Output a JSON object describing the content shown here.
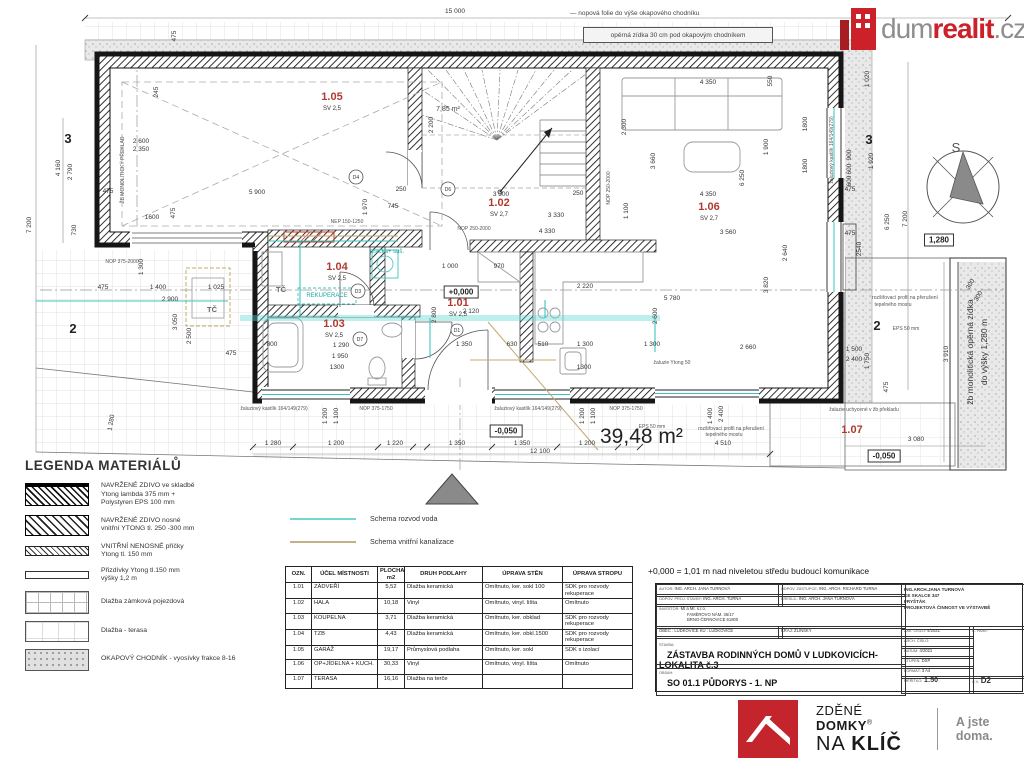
{
  "header": {
    "dim_total": "15 000",
    "note_folie": "— nopová folie do výše okapového chodníku",
    "note_zidka": "opěrná zídka 30 cm pod okapovým chodníkem",
    "logo": {
      "gray1": "dum",
      "red": "realit",
      "gray2": ".cz"
    }
  },
  "plan": {
    "compass_letter": "S",
    "area_label": "39,48 m²",
    "rooms": [
      {
        "id": "1.05",
        "sv": "SV 2,5",
        "x": 332,
        "y": 100
      },
      {
        "id": "1.02",
        "sv": "SV 2,7",
        "x": 499,
        "y": 206
      },
      {
        "id": "1.06",
        "sv": "SV 2,7",
        "x": 709,
        "y": 210
      },
      {
        "id": "1.04",
        "sv": "SV 2,5",
        "x": 337,
        "y": 270
      },
      {
        "id": "1.03",
        "sv": "SV 2,5",
        "x": 334,
        "y": 327
      },
      {
        "id": "1.01",
        "sv": "SV 2,5",
        "x": 458,
        "y": 306
      },
      {
        "id": "1.07",
        "sv": "",
        "x": 852,
        "y": 433
      }
    ],
    "levels": [
      {
        "t": "+0,000",
        "x": 461,
        "y": 292
      },
      {
        "t": "-0,050",
        "x": 506,
        "y": 431
      },
      {
        "t": "-0,050",
        "x": 884,
        "y": 456
      },
      {
        "t": "1,280",
        "x": 939,
        "y": 240
      }
    ],
    "annotations": [
      {
        "t": "15 000",
        "x": 455,
        "y": 13
      },
      {
        "t": "475",
        "x": 176,
        "y": 36,
        "r": -90
      },
      {
        "t": "7 200",
        "x": 31,
        "y": 225,
        "r": -90
      },
      {
        "t": "4 160",
        "x": 60,
        "y": 168,
        "r": -90
      },
      {
        "t": "2 790",
        "x": 72,
        "y": 172,
        "r": -90
      },
      {
        "t": "730",
        "x": 76,
        "y": 230,
        "r": -90
      },
      {
        "t": "3",
        "x": 68,
        "y": 143,
        "c": "g"
      },
      {
        "t": "2",
        "x": 73,
        "y": 333,
        "c": "g"
      },
      {
        "t": "2 600",
        "x": 141,
        "y": 143
      },
      {
        "t": "2 350",
        "x": 141,
        "y": 151
      },
      {
        "t": "245",
        "x": 158,
        "y": 92,
        "r": -90
      },
      {
        "t": "ŽB MONOLITICKÝ PŘEKLAD",
        "x": 124,
        "y": 170,
        "r": -90,
        "c": "t"
      },
      {
        "t": "475",
        "x": 108,
        "y": 193
      },
      {
        "t": "1600",
        "x": 152,
        "y": 219
      },
      {
        "t": "475",
        "x": 175,
        "y": 213,
        "r": -90
      },
      {
        "t": "NOP 375-2000",
        "x": 122,
        "y": 263,
        "c": "t"
      },
      {
        "t": "1 300",
        "x": 143,
        "y": 267,
        "r": -90
      },
      {
        "t": "475",
        "x": 103,
        "y": 289
      },
      {
        "t": "1 400",
        "x": 158,
        "y": 289
      },
      {
        "t": "1 025",
        "x": 216,
        "y": 289
      },
      {
        "t": "2 900",
        "x": 170,
        "y": 301
      },
      {
        "t": "3 050",
        "x": 177,
        "y": 322,
        "r": -90
      },
      {
        "t": "2 500",
        "x": 191,
        "y": 336,
        "r": -90
      },
      {
        "t": "TČ",
        "x": 212,
        "y": 312,
        "c": "k2"
      },
      {
        "t": "475",
        "x": 231,
        "y": 355
      },
      {
        "t": "1 280",
        "x": 113,
        "y": 423,
        "r": -80
      },
      {
        "t": "5 900",
        "x": 257,
        "y": 194
      },
      {
        "t": "250",
        "x": 401,
        "y": 191
      },
      {
        "t": "745",
        "x": 393,
        "y": 208
      },
      {
        "t": "1 970",
        "x": 367,
        "y": 207,
        "r": -90
      },
      {
        "t": "NEP 150-1250",
        "x": 347,
        "y": 223,
        "c": "t"
      },
      {
        "t": "7,85 m²",
        "x": 448,
        "y": 111,
        "c": "t2"
      },
      {
        "t": "2 200",
        "x": 433,
        "y": 125,
        "r": -90
      },
      {
        "t": "3 300",
        "x": 501,
        "y": 196
      },
      {
        "t": "250",
        "x": 578,
        "y": 195
      },
      {
        "t": "3 330",
        "x": 556,
        "y": 217
      },
      {
        "t": "NOP 250-2000",
        "x": 474,
        "y": 230,
        "c": "t"
      },
      {
        "t": "4 330",
        "x": 547,
        "y": 233
      },
      {
        "t": "2 300",
        "x": 626,
        "y": 127,
        "r": -90
      },
      {
        "t": "3 660",
        "x": 655,
        "y": 161,
        "r": -90
      },
      {
        "t": "1 100",
        "x": 628,
        "y": 211,
        "r": -90
      },
      {
        "t": "NOP 250-2000",
        "x": 610,
        "y": 188,
        "r": -90,
        "c": "t"
      },
      {
        "t": "4 350",
        "x": 708,
        "y": 84
      },
      {
        "t": "550",
        "x": 772,
        "y": 81,
        "r": -90
      },
      {
        "t": "1 900",
        "x": 768,
        "y": 147,
        "r": -90
      },
      {
        "t": "6 250",
        "x": 744,
        "y": 178,
        "r": -90
      },
      {
        "t": "4 350",
        "x": 708,
        "y": 196
      },
      {
        "t": "3 560",
        "x": 728,
        "y": 234
      },
      {
        "t": "2 640",
        "x": 787,
        "y": 253,
        "r": -90
      },
      {
        "t": "3 820",
        "x": 768,
        "y": 285,
        "r": -90
      },
      {
        "t": "2 660",
        "x": 748,
        "y": 349
      },
      {
        "t": "5 780",
        "x": 672,
        "y": 300
      },
      {
        "t": "2 600",
        "x": 657,
        "y": 316,
        "r": -90
      },
      {
        "t": "2 220",
        "x": 585,
        "y": 288
      },
      {
        "t": "1800",
        "x": 807,
        "y": 124,
        "r": -90
      },
      {
        "t": "1800",
        "x": 807,
        "y": 166,
        "r": -90
      },
      {
        "t": "žaluziový kastlík 164/149(279)",
        "x": 833,
        "y": 150,
        "r": -90,
        "c": "t"
      },
      {
        "t": "1 000",
        "x": 450,
        "y": 268
      },
      {
        "t": "970",
        "x": 499,
        "y": 268
      },
      {
        "t": "2 120",
        "x": 471,
        "y": 313
      },
      {
        "t": "2 800",
        "x": 436,
        "y": 315,
        "r": -90
      },
      {
        "t": "1 350",
        "x": 464,
        "y": 346
      },
      {
        "t": "630",
        "x": 512,
        "y": 346
      },
      {
        "t": "510",
        "x": 543,
        "y": 346
      },
      {
        "t": "1 300",
        "x": 585,
        "y": 346
      },
      {
        "t": "1 300",
        "x": 652,
        "y": 346
      },
      {
        "t": "1300",
        "x": 584,
        "y": 369
      },
      {
        "t": "žaluzie Ytong 50",
        "x": 672,
        "y": 364,
        "c": "t"
      },
      {
        "t": "REKUPERACE",
        "x": 327,
        "y": 297,
        "c": "v"
      },
      {
        "t": "pračka+ suš.",
        "x": 387,
        "y": 253,
        "c": "v"
      },
      {
        "t": "TČ",
        "x": 281,
        "y": 292,
        "c": "k2"
      },
      {
        "t": "800",
        "x": 272,
        "y": 346
      },
      {
        "t": "1 290",
        "x": 341,
        "y": 347
      },
      {
        "t": "1 950",
        "x": 340,
        "y": 358
      },
      {
        "t": "1300",
        "x": 337,
        "y": 369
      },
      {
        "t": "žaluziový kastlík 164/149(279)",
        "x": 274,
        "y": 410,
        "c": "t"
      },
      {
        "t": "NOP 375-1750",
        "x": 376,
        "y": 410,
        "c": "t"
      },
      {
        "t": "žaluziový kastlík 164/149(279)",
        "x": 528,
        "y": 410,
        "c": "t"
      },
      {
        "t": "NOP 375-1750",
        "x": 626,
        "y": 410,
        "c": "t"
      },
      {
        "t": "1 200",
        "x": 327,
        "y": 416,
        "r": -90
      },
      {
        "t": "1 100",
        "x": 338,
        "y": 416,
        "r": -90
      },
      {
        "t": "1 200",
        "x": 584,
        "y": 416,
        "r": -90
      },
      {
        "t": "1 100",
        "x": 595,
        "y": 416,
        "r": -90
      },
      {
        "t": "1 280",
        "x": 273,
        "y": 445
      },
      {
        "t": "1 200",
        "x": 336,
        "y": 445
      },
      {
        "t": "1 220",
        "x": 395,
        "y": 445
      },
      {
        "t": "1 350",
        "x": 457,
        "y": 445
      },
      {
        "t": "1 350",
        "x": 522,
        "y": 445
      },
      {
        "t": "1 200",
        "x": 587,
        "y": 445
      },
      {
        "t": "12 100",
        "x": 540,
        "y": 453
      },
      {
        "t": "EPS 50 mm",
        "x": 652,
        "y": 428,
        "c": "t"
      },
      {
        "t": "rozšiřovací profil na přerušení",
        "x": 731,
        "y": 430,
        "c": "t"
      },
      {
        "t": "tepelného mostu",
        "x": 724,
        "y": 436,
        "c": "t"
      },
      {
        "t": "4 510",
        "x": 723,
        "y": 445
      },
      {
        "t": "1 400",
        "x": 712,
        "y": 416,
        "r": -90
      },
      {
        "t": "2 400",
        "x": 723,
        "y": 414,
        "r": -90
      },
      {
        "t": "1 020",
        "x": 869,
        "y": 79,
        "r": -90
      },
      {
        "t": "3",
        "x": 869,
        "y": 144,
        "c": "g"
      },
      {
        "t": "900",
        "x": 851,
        "y": 155,
        "r": -90
      },
      {
        "t": "600",
        "x": 851,
        "y": 169,
        "r": -90
      },
      {
        "t": "600",
        "x": 851,
        "y": 181,
        "r": -90
      },
      {
        "t": "1 920",
        "x": 873,
        "y": 161,
        "r": -90
      },
      {
        "t": "475",
        "x": 850,
        "y": 191
      },
      {
        "t": "475",
        "x": 850,
        "y": 235
      },
      {
        "t": "2540",
        "x": 861,
        "y": 249,
        "r": -90
      },
      {
        "t": "6 250",
        "x": 889,
        "y": 222,
        "r": -90
      },
      {
        "t": "7 200",
        "x": 907,
        "y": 219,
        "r": -90
      },
      {
        "t": "300",
        "x": 972,
        "y": 285,
        "r": -60
      },
      {
        "t": "300",
        "x": 980,
        "y": 297,
        "r": -60
      },
      {
        "t": "3 910",
        "x": 948,
        "y": 354,
        "r": -90
      },
      {
        "t": "1 500",
        "x": 854,
        "y": 351
      },
      {
        "t": "2 400",
        "x": 854,
        "y": 361
      },
      {
        "t": "1 750",
        "x": 869,
        "y": 361,
        "r": -90
      },
      {
        "t": "475",
        "x": 888,
        "y": 387,
        "r": -90
      },
      {
        "t": "rozšiřovací profil na přerušení",
        "x": 905,
        "y": 299,
        "c": "t"
      },
      {
        "t": "tepelného mostu",
        "x": 893,
        "y": 306,
        "c": "t"
      },
      {
        "t": "2",
        "x": 877,
        "y": 330,
        "c": "g"
      },
      {
        "t": "EPS 50 mm",
        "x": 906,
        "y": 330,
        "c": "t"
      },
      {
        "t": "žaluzie uchycené v žb překladu",
        "x": 864,
        "y": 411,
        "c": "t"
      },
      {
        "t": "3 080",
        "x": 916,
        "y": 441
      },
      {
        "t": "žb monolitická opěrná zídka",
        "x": 973,
        "y": 352,
        "r": -90,
        "c": "n2"
      },
      {
        "t": "do výšky 1,280 m",
        "x": 987,
        "y": 352,
        "r": -90,
        "c": "n2"
      },
      {
        "t": "D4",
        "x": 356,
        "y": 179,
        "c": "o"
      },
      {
        "t": "D6",
        "x": 448,
        "y": 191,
        "c": "o"
      },
      {
        "t": "D3",
        "x": 358,
        "y": 293,
        "c": "o"
      },
      {
        "t": "D7",
        "x": 360,
        "y": 341,
        "c": "o"
      },
      {
        "t": "D1",
        "x": 457,
        "y": 332,
        "c": "o"
      }
    ]
  },
  "legend": {
    "title": "LEGENDA MATERIÁLŮ",
    "items": [
      {
        "type": "wall-eps",
        "lines": [
          "NAVRŽENÉ ZDIVO ve skladbě",
          "Ytong lambda 375 mm +",
          "Polystyren EPS 100 mm"
        ]
      },
      {
        "type": "wall-load",
        "lines": [
          "NAVRŽENÉ ZDIVO nosné",
          "vnitřní YTONG tl. 250 -300 mm"
        ]
      },
      {
        "type": "partition",
        "lines": [
          "VNITŘNÍ NENOSNÉ příčky",
          "Ytong tl. 150 mm"
        ]
      },
      {
        "type": "plain-thin",
        "lines": [
          "Přizdívky Ytong tl.150 mm",
          "výšky 1,2 m"
        ]
      },
      {
        "type": "grid",
        "lines": [
          "Dlažba zámková pojezdová"
        ]
      },
      {
        "type": "terrace",
        "lines": [
          "Dlažba - terasa"
        ]
      },
      {
        "type": "gravel",
        "lines": [
          "OKAPOVÝ CHODNÍK - vyosívky frakce 8-16"
        ]
      }
    ]
  },
  "schema": [
    {
      "label": "Schema rozvod voda",
      "color": "#74d8d2"
    },
    {
      "label": "Schema vnitřní kanalizace",
      "color": "#c3b187"
    }
  ],
  "room_table": {
    "headers": [
      "OZN.",
      "ÚČEL MÍSTNOSTI",
      "PLOCHA m2",
      "DRUH PODLAHY",
      "ÚPRAVA STĚN",
      "ÚPRAVA STROPU"
    ],
    "rows": [
      [
        "1.01",
        "ZÁDVEŘÍ",
        "5,52",
        "Dlažba keramická",
        "Omítnuto, ker. sokl 100",
        "SDK pro rozvody rekuperace"
      ],
      [
        "1.02",
        "HALA",
        "10,18",
        "Vinyl",
        "Omítnuto, vinyl. lišta",
        "Omítnuto"
      ],
      [
        "1.03",
        "KOUPELNA",
        "3,71",
        "Dlažba keramická",
        "Omítnuto, ker. obklad",
        "SDK pro rozvody rekuperace"
      ],
      [
        "1.04",
        "TZB",
        "4,43",
        "Dlažba keramická",
        "Omítnuto, ker. obkl.1500",
        "SDK pro rozvody rekuperace"
      ],
      [
        "1.05",
        "GARÁŽ",
        "19,17",
        "Průmyslová podlaha",
        "Omítnuto, ker. sokl",
        "SDK s izolací"
      ],
      [
        "1.06",
        "OP+JÍDELNA + KUCH.",
        "30,33",
        "Vinyl",
        "Omítnuto, vinyl. lišta",
        "Omítnuto"
      ],
      [
        "1.07",
        "TERASA",
        "16,16",
        "Dlažba na terče",
        "",
        ""
      ]
    ]
  },
  "title_block": {
    "datum_note": "+0,000 = 1,01 m nad niveletou středu budoucí komunikace",
    "autor_label": "AUTOR:",
    "autor": "ING. ARCH. JANA TURNOVÁ",
    "zastupce_label": "ODPOV. ZÁSTUPCE:",
    "zastupce": "ING. ARCH. RICHARD TURNA",
    "proj_label": "ODPOV. PROJ. STAVBY:",
    "proj": "ING. ARCH. TURNA",
    "kreslil_label": "KRESLIL:",
    "kreslil": "ING. ARCH. JANA TURNOVÁ",
    "investor_label": "INVESTOR:",
    "inv1": "MI a MI. s.r.o.",
    "inv2": "FAMĚROVO NÁM. 36/17",
    "inv3": "BRNO-ČERNOVICE 61800",
    "obec": "OBEC : LUDKOVICE    KÚ : LUDKOVICE",
    "kraj": "KRAJ: ZLÍNSKÝ",
    "comp1": "ING.ARCH.JANA TURNOVÁ",
    "comp2": "KE SKALCE 347",
    "comp3": "FRYŠTÁK",
    "comp4": "PROJEKTOVÁ ČINNOST VE VÝSTAVBĚ",
    "zak_label": "ZAK. ČÍSLO:",
    "zak": "4/2021",
    "arch_label": "ARCH. ČÍSLO:",
    "datum_label": "DATUM:",
    "datum": "4/2021",
    "stupen_label": "STUPEŇ:",
    "stupen": "DSP",
    "format_label": "FORMÁT:",
    "format": "3 A4",
    "pare_label": "Č. PARÉ:",
    "stavba_label": "STAVBA:",
    "stavba": "ZÁSTAVBA RODINNÝCH DOMŮ V LUDKOVICÍCH- LOKALITA č.3",
    "obsah_label": "OBSAH:",
    "obsah": "SO 01.1 PŮDORYS - 1. NP",
    "meritko_label": "MĚŘÍTKO:",
    "meritko": "1:50",
    "cv_label": "C.V.",
    "cv": "D2"
  },
  "footer": {
    "line1a": "ZDĚNÉ ",
    "line1b": "DOMKY",
    "reg": "®",
    "line2a": "NA ",
    "line2b": "KLÍČ",
    "tagline": "A jste doma."
  }
}
